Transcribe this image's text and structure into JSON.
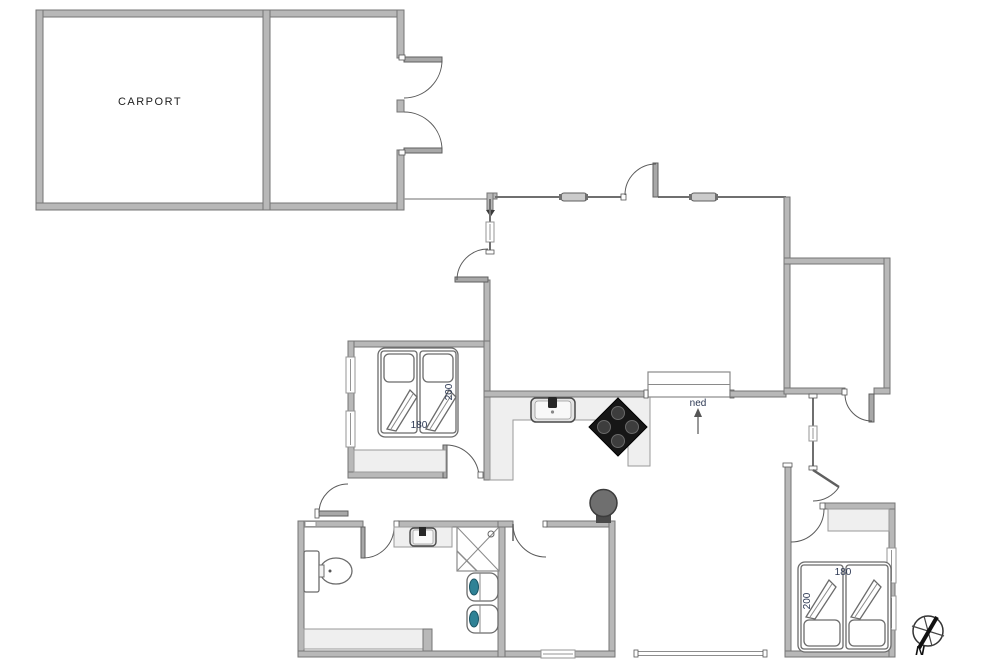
{
  "plan_type": "holiday-house-floor-plan",
  "labels": {
    "carport": "CARPORT",
    "stairs": "ned",
    "north": "N"
  },
  "beds": {
    "nw": {
      "width": "180",
      "length": "200"
    },
    "se": {
      "width": "180",
      "length": "200"
    }
  },
  "icons": [
    "window-icon",
    "door-swing-icon",
    "double-door-icon",
    "stairs-icon",
    "kitchen-sink-icon",
    "stove-hob-icon",
    "wood-stove-icon",
    "toilet-icon",
    "washbasin-icon",
    "shower-icon",
    "bathroom-sink-icon",
    "double-bed-icon",
    "wardrobe-icon",
    "bench-icon",
    "outdoor-tap-icon",
    "compass-icon"
  ],
  "colors": {
    "background": "#ffffff",
    "wall_fill": "#b8b8b8",
    "wall_stroke": "#757575",
    "thin_wall": "#6f6f6f",
    "furniture_fill": "#efefef",
    "stove_black": "#161616",
    "wood_stove_gray": "#6f6f6f",
    "water_teal": "#2f8296",
    "dimension_text": "#2c3853"
  }
}
